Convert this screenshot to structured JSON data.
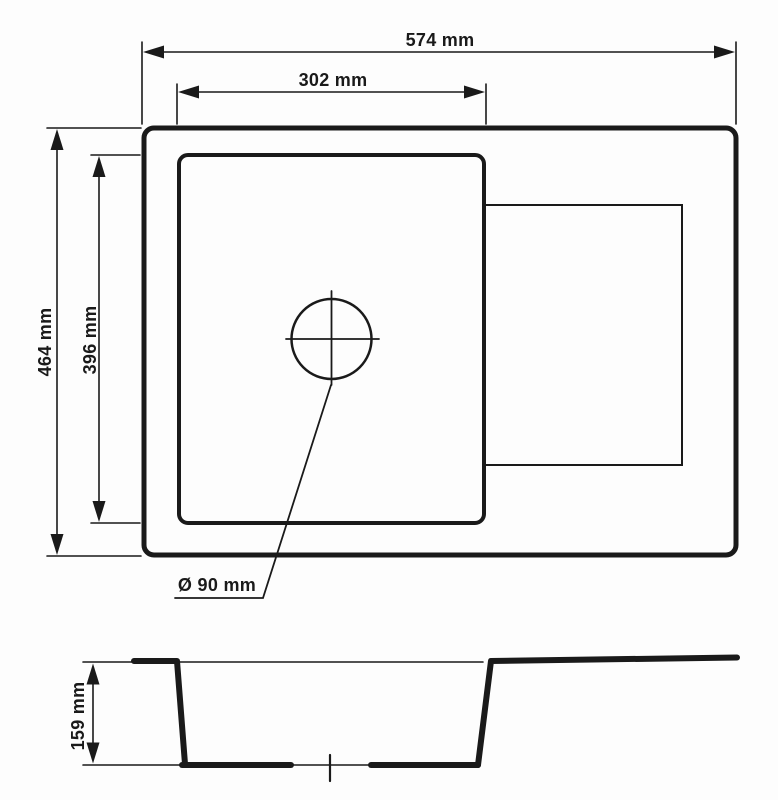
{
  "colors": {
    "ink": "#1a1a1a",
    "background": "#fdfdfd"
  },
  "top_view": {
    "labels": {
      "overall_width": "574 mm",
      "bowl_width": "302 mm",
      "overall_depth": "464 mm",
      "bowl_depth": "396 mm",
      "drain_diameter": "Ø 90 mm"
    },
    "values": {
      "overall_width_mm": 574,
      "bowl_width_mm": 302,
      "overall_depth_mm": 464,
      "bowl_depth_mm": 396,
      "drain_diameter_mm": 90
    }
  },
  "section_view": {
    "labels": {
      "bowl_depth": "159 mm"
    },
    "values": {
      "bowl_depth_mm": 159
    }
  }
}
